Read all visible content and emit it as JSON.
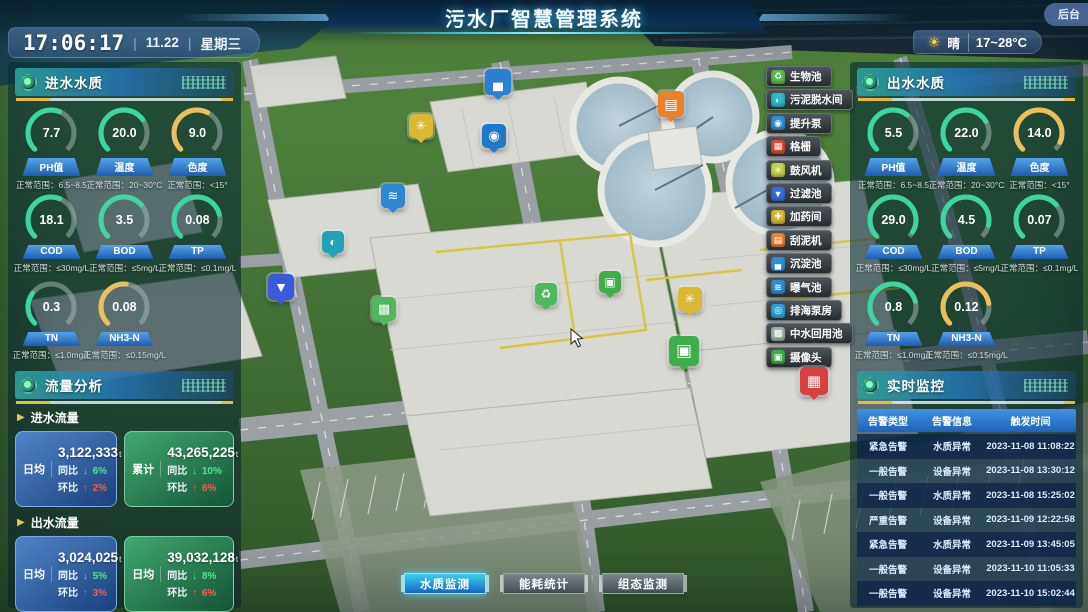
{
  "header": {
    "title": "污水厂智慧管理系统",
    "backstage": "后台"
  },
  "clock": {
    "time": "17:06:17",
    "date": "11.22",
    "weekday": "星期三"
  },
  "weather": {
    "icon": "sun-icon",
    "condition": "晴",
    "range": "17~28°C"
  },
  "panels": {
    "inlet": {
      "title": "进水水质",
      "gauges": [
        {
          "label": "PH值",
          "value": "7.7",
          "range": "正常范围：6.5~8.5",
          "color": "#3ed6a0",
          "pct": 0.58
        },
        {
          "label": "温度",
          "value": "20.0",
          "range": "正常范围：20~30°C",
          "color": "#3ed6a0",
          "pct": 0.7
        },
        {
          "label": "色度",
          "value": "9.0",
          "range": "正常范围：<15°",
          "color": "#e9c05c",
          "pct": 0.6
        },
        {
          "label": "COD",
          "value": "18.1",
          "range": "正常范围：≤30mg/L",
          "color": "#3ed6a0",
          "pct": 0.58
        },
        {
          "label": "BOD",
          "value": "3.5",
          "range": "正常范围：≤5mg/L",
          "color": "#3ed6a0",
          "pct": 0.68
        },
        {
          "label": "TP",
          "value": "0.08",
          "range": "正常范围：≤0.1mg/L",
          "color": "#3ed6a0",
          "pct": 0.78
        },
        {
          "label": "TN",
          "value": "0.3",
          "range": "正常范围：≤1.0mg/L",
          "color": "#3ed6a0",
          "pct": 0.3
        },
        {
          "label": "NH3-N",
          "value": "0.08",
          "range": "正常范围：≤0.15mg/L",
          "color": "#e9c05c",
          "pct": 0.52
        }
      ]
    },
    "outlet": {
      "title": "出水水质",
      "gauges": [
        {
          "label": "PH值",
          "value": "5.5",
          "range": "正常范围：6.5~8.5",
          "color": "#3ed6a0",
          "pct": 0.64
        },
        {
          "label": "温度",
          "value": "22.0",
          "range": "正常范围：20~30°C",
          "color": "#3ed6a0",
          "pct": 0.72
        },
        {
          "label": "色度",
          "value": "14.0",
          "range": "正常范围：<15°",
          "color": "#e9c05c",
          "pct": 0.92
        },
        {
          "label": "COD",
          "value": "29.0",
          "range": "正常范围：≤30mg/L",
          "color": "#3ed6a0",
          "pct": 0.95
        },
        {
          "label": "BOD",
          "value": "4.5",
          "range": "正常范围：≤5mg/L",
          "color": "#3ed6a0",
          "pct": 0.88
        },
        {
          "label": "TP",
          "value": "0.07",
          "range": "正常范围：≤0.1mg/L",
          "color": "#3ed6a0",
          "pct": 0.68
        },
        {
          "label": "TN",
          "value": "0.8",
          "range": "正常范围：≤1.0mg/L",
          "color": "#3ed6a0",
          "pct": 0.78
        },
        {
          "label": "NH3-N",
          "value": "0.12",
          "range": "正常范围：≤0.15mg/L",
          "color": "#e9c05c",
          "pct": 0.8
        }
      ]
    },
    "flow": {
      "title": "流量分析",
      "groups": [
        {
          "label": "进水流量",
          "cards": [
            {
              "theme": "blue",
              "period": "日均",
              "value": "3,122,333",
              "unit": "t",
              "rows": [
                {
                  "k": "同比",
                  "dir": "down",
                  "v": "6%"
                },
                {
                  "k": "环比",
                  "dir": "up",
                  "v": "2%"
                }
              ]
            },
            {
              "theme": "green",
              "period": "累计",
              "value": "43,265,225",
              "unit": "t",
              "rows": [
                {
                  "k": "同比",
                  "dir": "down",
                  "v": "10%"
                },
                {
                  "k": "环比",
                  "dir": "up",
                  "v": "6%"
                }
              ]
            }
          ]
        },
        {
          "label": "出水流量",
          "cards": [
            {
              "theme": "blue",
              "period": "日均",
              "value": "3,024,025",
              "unit": "t",
              "rows": [
                {
                  "k": "同比",
                  "dir": "down",
                  "v": "5%"
                },
                {
                  "k": "环比",
                  "dir": "up",
                  "v": "3%"
                }
              ]
            },
            {
              "theme": "green",
              "period": "日均",
              "value": "39,032,128",
              "unit": "t",
              "rows": [
                {
                  "k": "同比",
                  "dir": "down",
                  "v": "8%"
                },
                {
                  "k": "环比",
                  "dir": "up",
                  "v": "6%"
                }
              ]
            }
          ]
        }
      ]
    },
    "monitor": {
      "title": "实时监控",
      "columns": [
        "告警类型",
        "告警信息",
        "触发时间"
      ],
      "rows": [
        [
          "紧急告警",
          "水质异常",
          "2023-11-08 11:08:22"
        ],
        [
          "一般告警",
          "设备异常",
          "2023-11-08 13:30:12"
        ],
        [
          "一般告警",
          "水质异常",
          "2023-11-08 15:25:02"
        ],
        [
          "严重告警",
          "设备异常",
          "2023-11-09 12:22:58"
        ],
        [
          "紧急告警",
          "水质异常",
          "2023-11-09 13:45:05"
        ],
        [
          "一般告警",
          "设备异常",
          "2023-11-10 11:05:33"
        ],
        [
          "一般告警",
          "设备异常",
          "2023-11-10 15:02:44"
        ]
      ]
    }
  },
  "map_menu": [
    {
      "label": "生物池",
      "icon": "bio-pool-icon",
      "color": "#62b94e",
      "glyph": "♻"
    },
    {
      "label": "污泥脱水间",
      "icon": "sludge-dewatering-icon",
      "color": "#2fb8c9",
      "glyph": "◐"
    },
    {
      "label": "提升泵",
      "icon": "lift-pump-icon",
      "color": "#2f8fd9",
      "glyph": "◉"
    },
    {
      "label": "格栅",
      "icon": "grille-icon",
      "color": "#d94a3a",
      "glyph": "▦"
    },
    {
      "label": "鼓风机",
      "icon": "blower-icon",
      "color": "#c3d24b",
      "glyph": "✳"
    },
    {
      "label": "过滤池",
      "icon": "filter-pool-icon",
      "color": "#3a6bd9",
      "glyph": "▼"
    },
    {
      "label": "加药间",
      "icon": "dosing-room-icon",
      "color": "#d9b832",
      "glyph": "✚"
    },
    {
      "label": "刮泥机",
      "icon": "mud-scraper-icon",
      "color": "#e8822d",
      "glyph": "▤"
    },
    {
      "label": "沉淀池",
      "icon": "sedimentation-icon",
      "color": "#2f8fd9",
      "glyph": "▄"
    },
    {
      "label": "曝气池",
      "icon": "aeration-icon",
      "color": "#2f8fd9",
      "glyph": "≋"
    },
    {
      "label": "排海泵房",
      "icon": "sea-pump-icon",
      "color": "#2fa3d9",
      "glyph": "◎"
    },
    {
      "label": "中水回用池",
      "icon": "reclaimed-water-icon",
      "color": "#9fb5a6",
      "glyph": "▩"
    },
    {
      "label": "摄像头",
      "icon": "camera-icon",
      "color": "#3fae4a",
      "glyph": "▣"
    }
  ],
  "map_markers": [
    {
      "name": "sedimentation-tank-marker",
      "x": 498,
      "y": 82,
      "size": 26,
      "color": "#2b7fd4",
      "glyph": "▄"
    },
    {
      "name": "mud-scraper-marker",
      "x": 671,
      "y": 104,
      "size": 26,
      "color": "#e8832c",
      "glyph": "▤"
    },
    {
      "name": "blower-marker",
      "x": 421,
      "y": 126,
      "size": 24,
      "color": "#d9b832",
      "glyph": "✳"
    },
    {
      "name": "lift-pump-marker",
      "x": 494,
      "y": 136,
      "size": 24,
      "color": "#1f78c8",
      "glyph": "◉"
    },
    {
      "name": "aeration-pool-marker",
      "x": 393,
      "y": 196,
      "size": 24,
      "color": "#2e86d4",
      "glyph": "≋"
    },
    {
      "name": "sludge-dewatering-marker",
      "x": 333,
      "y": 242,
      "size": 22,
      "color": "#21a3b5",
      "glyph": "◐"
    },
    {
      "name": "filter-pool-marker",
      "x": 281,
      "y": 287,
      "size": 26,
      "color": "#3a5bd9",
      "glyph": "▼"
    },
    {
      "name": "reclaimed-water-marker",
      "x": 384,
      "y": 309,
      "size": 24,
      "color": "#4db85c",
      "glyph": "▩"
    },
    {
      "name": "bio-pool-marker",
      "x": 546,
      "y": 294,
      "size": 22,
      "color": "#4db85c",
      "glyph": "♻"
    },
    {
      "name": "camera-marker-1",
      "x": 610,
      "y": 282,
      "size": 22,
      "color": "#3fae4a",
      "glyph": "▣"
    },
    {
      "name": "blower-marker-2",
      "x": 690,
      "y": 299,
      "size": 24,
      "color": "#d9b832",
      "glyph": "✳"
    },
    {
      "name": "camera-marker-2",
      "x": 684,
      "y": 351,
      "size": 30,
      "color": "#3fae4a",
      "glyph": "▣"
    },
    {
      "name": "grille-marker",
      "x": 814,
      "y": 381,
      "size": 28,
      "color": "#d94040",
      "glyph": "▦"
    }
  ],
  "bottom_tabs": [
    {
      "label": "水质监测",
      "active": true
    },
    {
      "label": "能耗统计",
      "active": false
    },
    {
      "label": "组态监测",
      "active": false
    }
  ]
}
